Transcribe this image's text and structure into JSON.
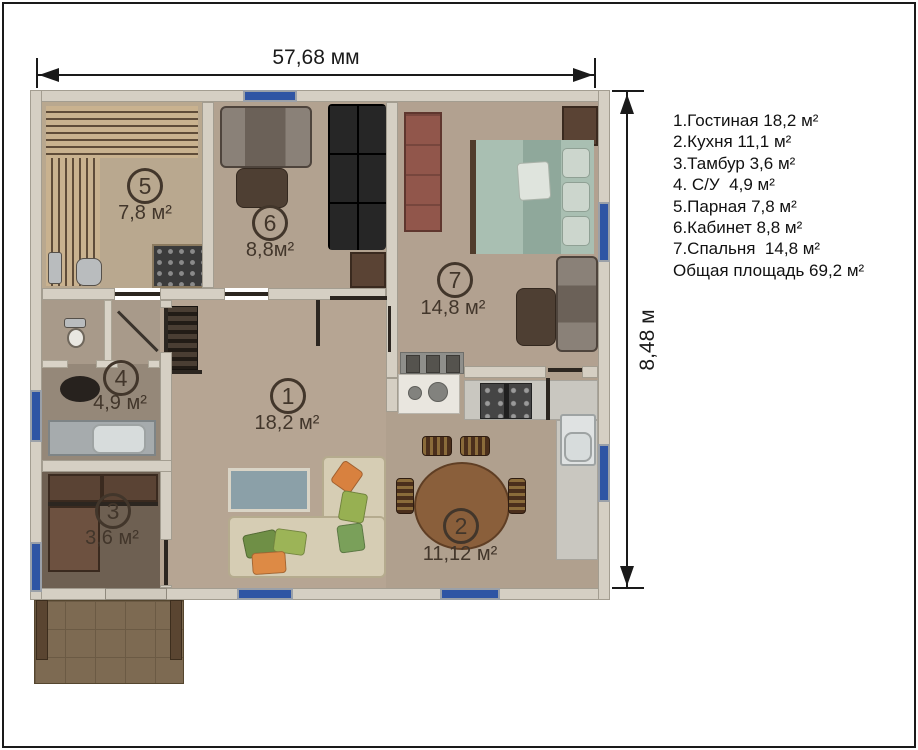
{
  "dim_top": "57,68 мм",
  "dim_right": "8,48 м",
  "legend": [
    "1.Гостиная 18,2 м²",
    "2.Кухня 11,1 м²",
    "3.Тамбур 3,6 м²",
    "4. С/У  4,9 м²",
    "5.Парная 7,8 м²",
    "6.Кабинет 8,8 м²",
    "7.Спальня  14,8 м²",
    "Общая площадь 69,2 м²"
  ],
  "rooms": {
    "living": {
      "num": "1",
      "name": "Гостиная",
      "area": "18,2 м²"
    },
    "kitchen": {
      "num": "2",
      "name": "Кухня",
      "area": "11,12 м²"
    },
    "entry": {
      "num": "3",
      "name": "Тамбур",
      "area": "3,6 м²"
    },
    "bath": {
      "num": "4",
      "name": "С/У",
      "area": "4,9 м²"
    },
    "sauna": {
      "num": "5",
      "name": "Парная",
      "area": "7,8 м²"
    },
    "office": {
      "num": "6",
      "name": "Кабинет",
      "area": "8,8м²"
    },
    "bedroom": {
      "num": "7",
      "name": "Спальня",
      "area": "14,8 м²"
    }
  },
  "total_area": "69,2 м²",
  "colors": {
    "window_blue": "#2f55a4",
    "wall_fill": "#d5cfc3",
    "label_brown": "#42362b",
    "legend_text": "#111111"
  }
}
